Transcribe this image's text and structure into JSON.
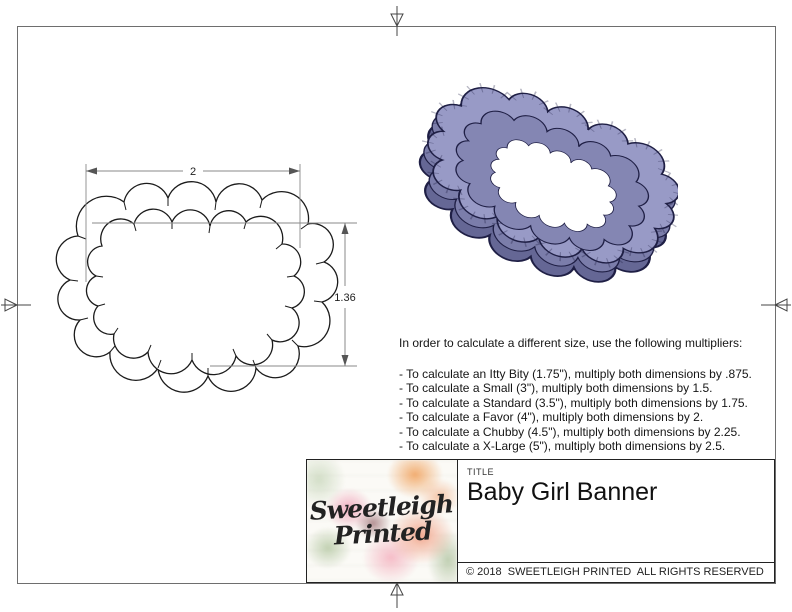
{
  "sheet": {
    "background": "#ffffff",
    "border_color": "#6e6e6e"
  },
  "drawing": {
    "dim_width_label": "2",
    "dim_height_label": "1.36",
    "outline_color": "#1b1b1b",
    "dim_line_color": "#8a8a8a"
  },
  "render": {
    "body_color": "#989ac6",
    "inner_wall_color": "#8486b3",
    "mid_wall_color": "#7b7daa",
    "depth_color": "#656795",
    "outline_color": "#1f1f45",
    "hole_color": "#ffffff"
  },
  "instructions": {
    "heading": "In order to calculate a different size, use the following multipliers:",
    "items": [
      "- To calculate an Itty Bity (1.75\"), multiply both dimensions by .875.",
      "- To calculate a Small (3\"), multiply both dimensions by 1.5.",
      "- To calculate a Standard (3.5\"), multiply both dimensions by 1.75.",
      "- To calculate a Favor (4\"), multiply both dimensions by 2.",
      "- To calculate a Chubby (4.5\"), multiply both dimensions by 2.25.",
      "- To calculate a X-Large (5\"), multiply both dimensions by 2.5."
    ]
  },
  "title_block": {
    "title_label": "TITLE",
    "title": "Baby Girl Banner",
    "copyright": "© 2018  SWEETLEIGH PRINTED  ALL RIGHTS RESERVED",
    "logo": {
      "line1": "Sweetleigh",
      "line2": "Printed"
    }
  }
}
